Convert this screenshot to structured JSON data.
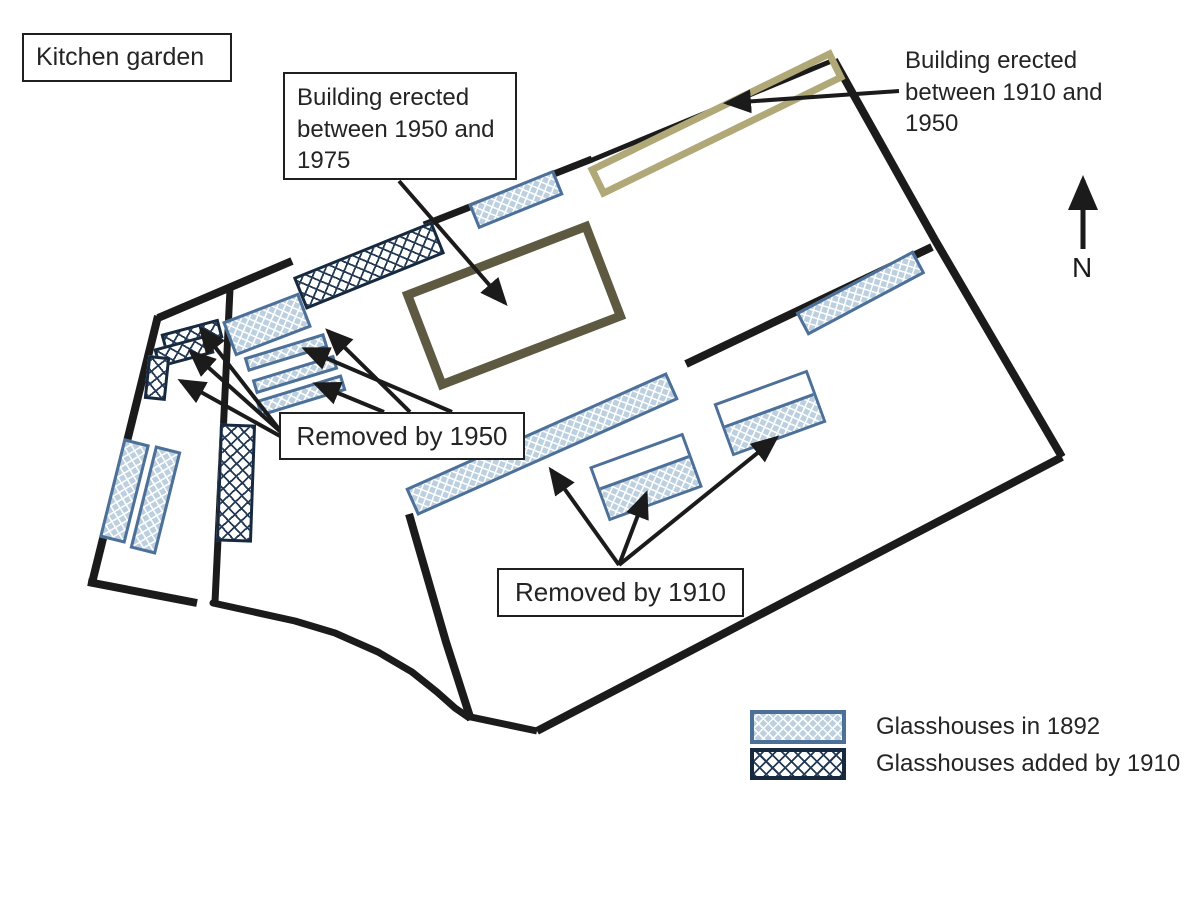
{
  "title": "Kitchen garden",
  "annotations": {
    "building_1950_1975": "Building erected between 1950 and 1975",
    "building_1910_1950": "Building erected between 1910 and 1950",
    "removed_by_1950": "Removed by 1950",
    "removed_by_1910": "Removed by 1910",
    "north": "N"
  },
  "legend": {
    "items": [
      {
        "label": "Glasshouses in 1892",
        "swatch": "blue-lattice",
        "border_color": "#4d7099",
        "fill_color": "#bdd0e0"
      },
      {
        "label": "Glasshouses added by 1910",
        "swatch": "navy-crosshatch",
        "border_color": "#16293f",
        "fill_color": "#ffffff"
      }
    ]
  },
  "colors": {
    "wall": "#1b1b1b",
    "building_1910_1950_outline": "#b1a878",
    "building_1950_1975_outline": "#5e5a42",
    "glasshouse_1892_border": "#4d7099",
    "glasshouse_1892_fill": "#bdd0e0",
    "glasshouse_1910_border": "#16293f"
  }
}
